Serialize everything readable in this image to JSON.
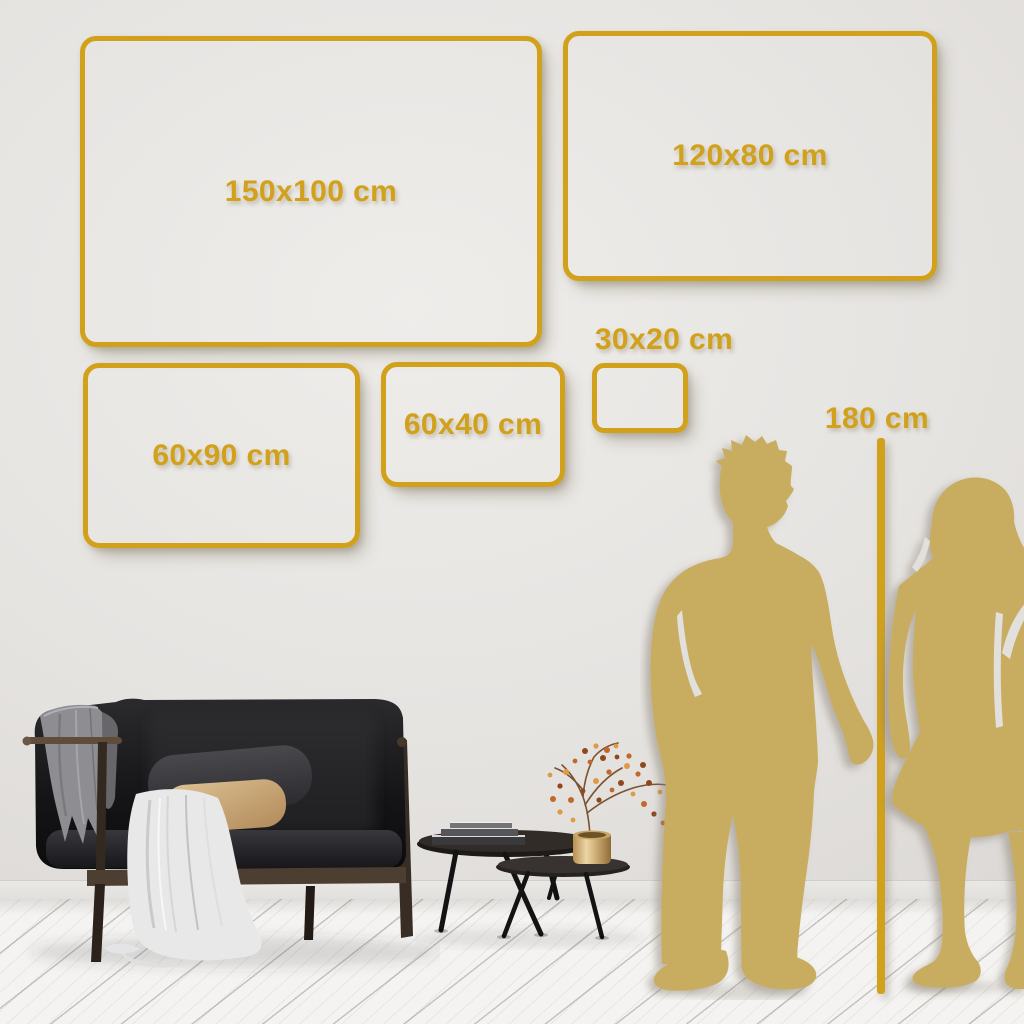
{
  "size_guide": {
    "frames": [
      {
        "label": "150x100 cm"
      },
      {
        "label": "120x80 cm"
      },
      {
        "label": "60x90 cm"
      },
      {
        "label": "60x40 cm"
      },
      {
        "label": "30x20 cm"
      }
    ],
    "height_marker": {
      "label": "180 cm"
    }
  },
  "colors": {
    "gold": "#D2A11B",
    "silhouette_gold": "#C8AD61",
    "wall": "#E6E4E1",
    "floor": "#F4F3F1",
    "sofa_black": "#1B1B1D",
    "wood_brown": "#4A3B2E",
    "pillow_tan": "#D2B080",
    "blanket_gray": "#8F8F93",
    "drape_white": "#E8E8E9",
    "pot_brass": "#D8BC84",
    "berry_orange": "#C1682A"
  }
}
